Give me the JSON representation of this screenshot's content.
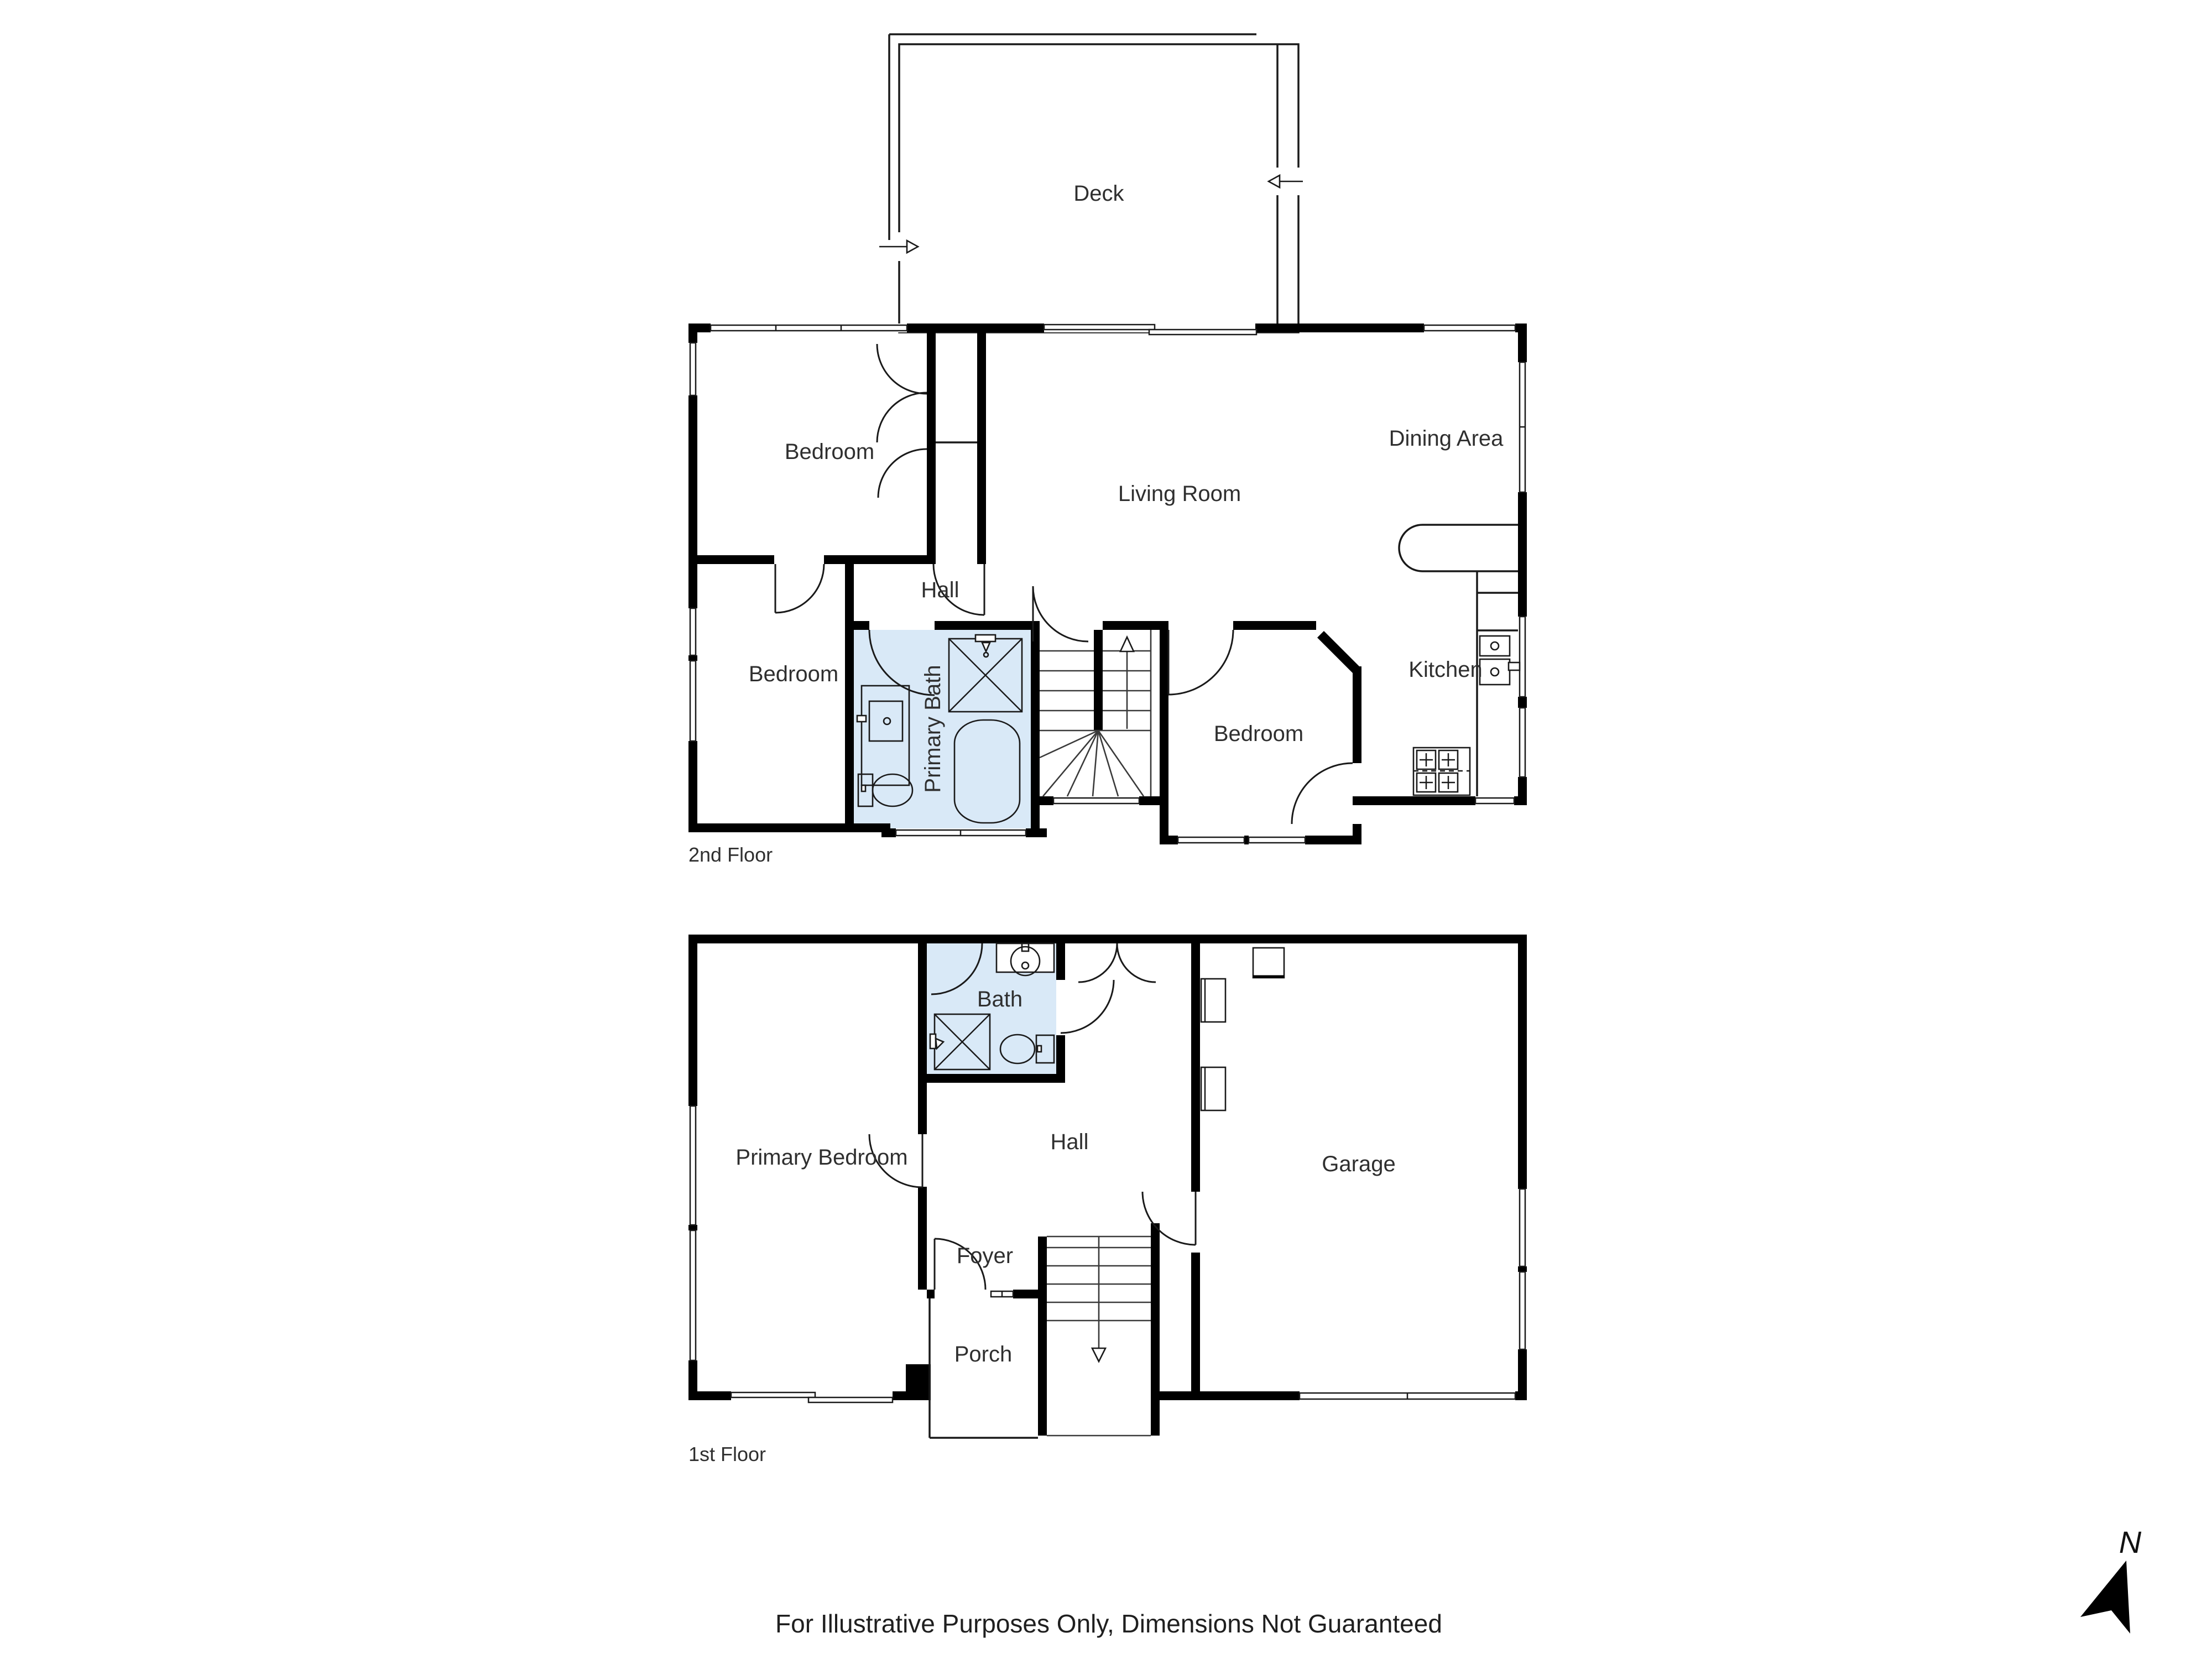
{
  "colors": {
    "wall": "#000000",
    "line": "#1a1a1a",
    "bath_fill": "#d9e9f7",
    "text": "#2f2f2f"
  },
  "floors": [
    {
      "name": "2nd Floor",
      "rooms": [
        {
          "label": "Deck"
        },
        {
          "label": "Bedroom"
        },
        {
          "label": "Living Room"
        },
        {
          "label": "Dining Area"
        },
        {
          "label": "Hall"
        },
        {
          "label": "Bedroom"
        },
        {
          "label": "Primary Bath"
        },
        {
          "label": "Bedroom"
        },
        {
          "label": "Kitchen"
        }
      ]
    },
    {
      "name": "1st Floor",
      "rooms": [
        {
          "label": "Bath"
        },
        {
          "label": "Primary Bedroom"
        },
        {
          "label": "Hall"
        },
        {
          "label": "Foyer"
        },
        {
          "label": "Porch"
        },
        {
          "label": "Garage"
        }
      ]
    }
  ],
  "compass": {
    "label": "N"
  },
  "footer": {
    "disclaimer": "For Illustrative Purposes Only, Dimensions Not Guaranteed"
  }
}
